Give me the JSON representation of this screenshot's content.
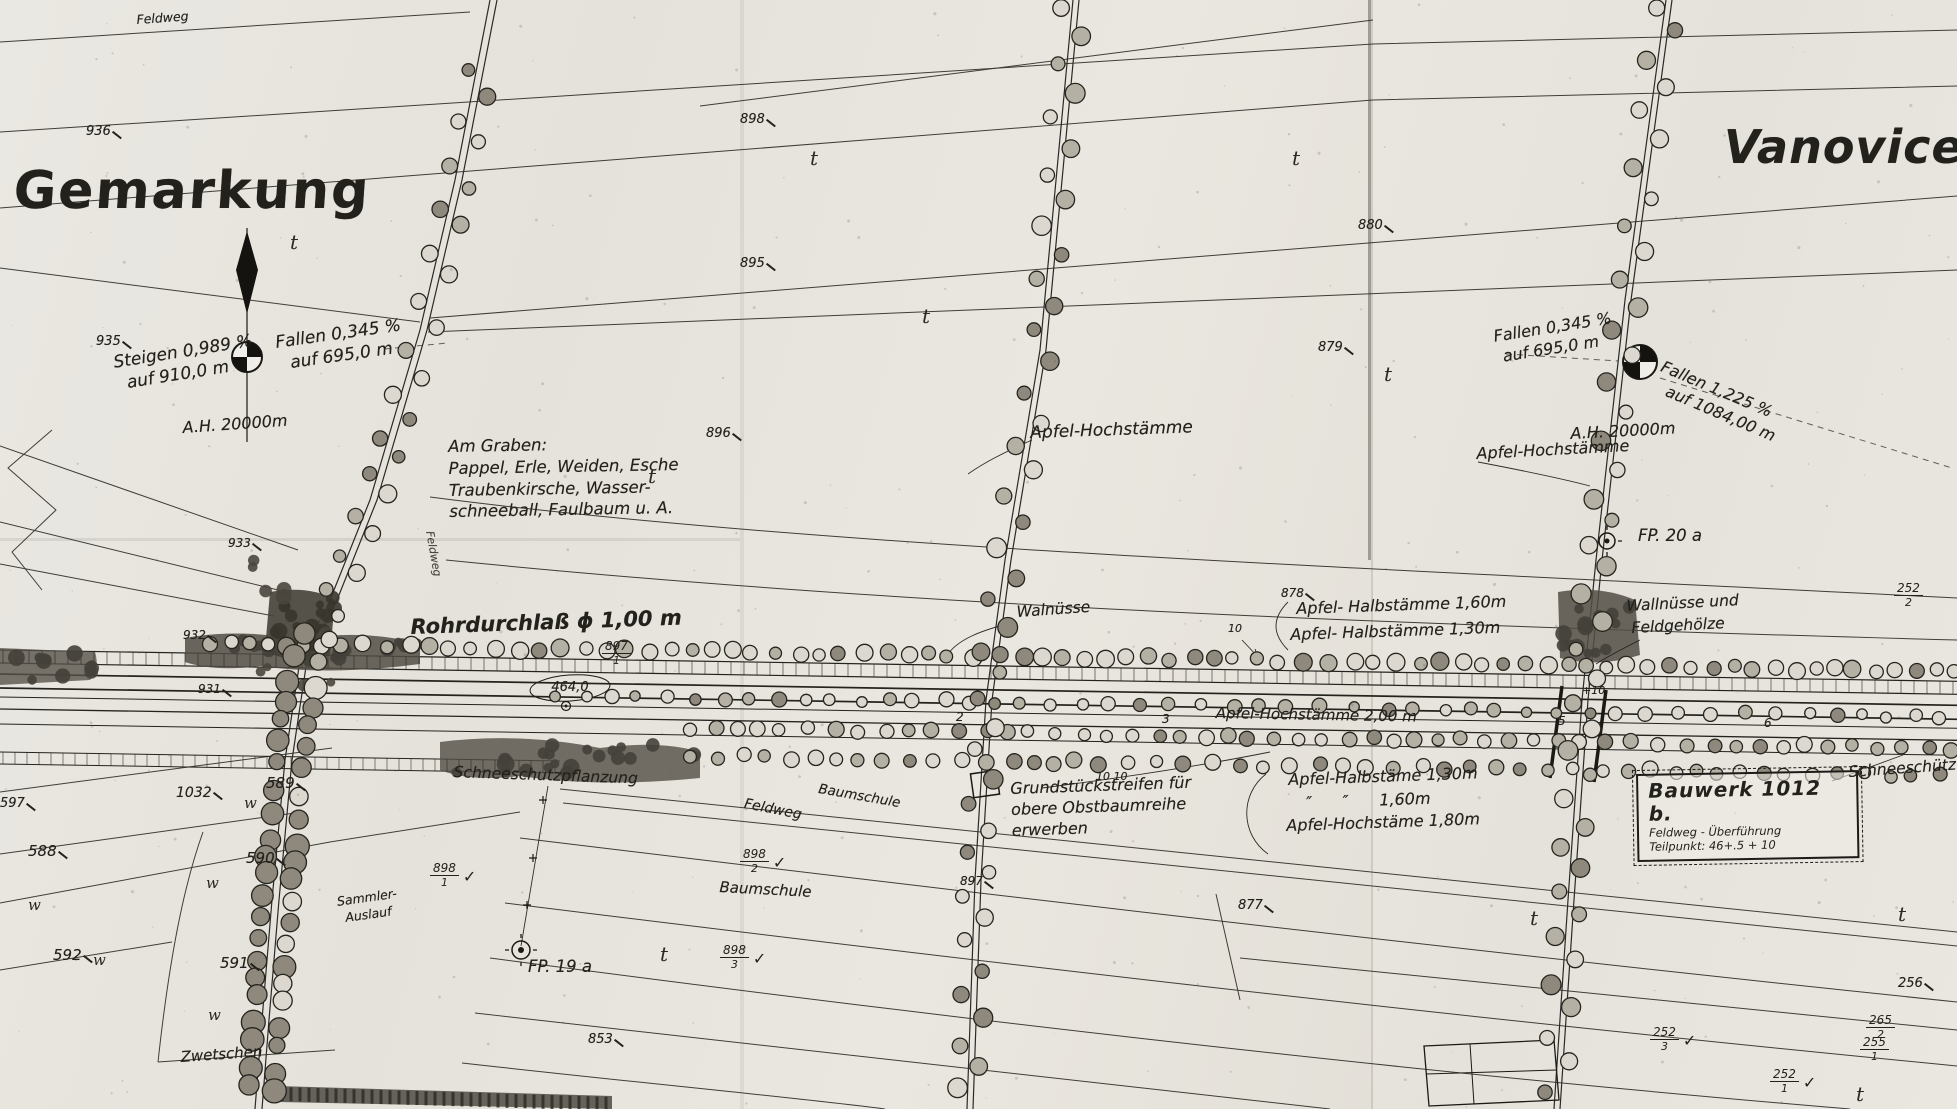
{
  "titles": {
    "gemarkung": "Gemarkung",
    "vanovice": "Vanovice"
  },
  "roads": {
    "feldweg_top": "Feldweg",
    "feldweg_mid": "Feldweg",
    "feldweg_road": "Feldweg"
  },
  "gradients": {
    "steigen": [
      "Steigen 0,989 %",
      "auf 910,0 m"
    ],
    "fallen_left": [
      "Fallen 0,345 %",
      "auf 695,0 m"
    ],
    "ah_left": "A.H. 20000m",
    "fallen_right": [
      "Fallen 0,345 %",
      "auf 695,0 m"
    ],
    "fallen_right2": [
      "Fallen 1,225 %",
      "auf 1084,00 m"
    ],
    "ah_right": "A.H. 20000m"
  },
  "notes": {
    "am_graben": [
      "Am Graben:",
      "Pappel, Erle, Weiden, Esche",
      "Traubenkirsche, Wasser-",
      "schneeball, Faulbaum u. A."
    ],
    "grundstueck": [
      "Grundstückstreifen für",
      "obere Obstbaumreihe",
      "erwerben"
    ]
  },
  "plantings": {
    "apfel_hoch_center": "Apfel-Hochstämme",
    "apfel_hoch_right": "Apfel-Hochstämme",
    "walnuesse": "Walnüsse",
    "halb_160": "Apfel- Halbstämme 1,60m",
    "halb_130": "Apfel- Halbstämme 1,30m",
    "wallnuesse_und": "Wallnüsse und",
    "feldgehoelze": "Feldgehölze",
    "hoch_200": "Apfel-Hochstämme 2,00 m",
    "halb_130b": "Apfel-Halbstäme 1,30m",
    "ditto_160": "″      ″      1,60m",
    "hoch_180": "Apfel-Hochstäme 1,80m",
    "schneeschutz_left": "Schneeschutzpflanzung",
    "schneeschutz_right": "Schneeschütz",
    "baumschule_1": "Baumschule",
    "baumschule_2": "Baumschule",
    "zwetschen": "Zwetschen"
  },
  "structures": {
    "rohrdurchlass": "Rohrdurchlaß ϕ 1,00 m",
    "bauwerk_title": "Bauwerk 1012 b.",
    "bauwerk_line1": "Feldweg - Überführung",
    "bauwerk_line2": "Teilpunkt: 46+.5 + 10",
    "sammler": [
      "Sammler-",
      "Auslauf"
    ],
    "fp19": "FP. 19 a",
    "fp20": "FP. 20 a",
    "station_464": "464,0"
  },
  "stations": {
    "s2": "2",
    "s3": "3",
    "s5": "5",
    "s6": "6",
    "plus10": "+10",
    "ten": "10",
    "tenten": "10 10"
  },
  "parcels": {
    "p936": "936",
    "p935": "935",
    "p933": "933",
    "p932": "932",
    "p931": "931",
    "p1032": "1032",
    "p589": "589",
    "p590": "590",
    "p588": "588",
    "p592": "592",
    "p591": "591",
    "p597": "597",
    "p898": "898",
    "p895": "895",
    "p896": "896",
    "p880": "880",
    "p879": "879",
    "p878": "878",
    "p877": "877",
    "p897": "897",
    "p853": "853",
    "p256": "256"
  },
  "fracs": {
    "f897_1": {
      "n": "897",
      "d": "1"
    },
    "f898_1": {
      "n": "898",
      "d": "1"
    },
    "f898_2": {
      "n": "898",
      "d": "2"
    },
    "f898_3": {
      "n": "898",
      "d": "3"
    },
    "f252_3": {
      "n": "252",
      "d": "3"
    },
    "f265_2": {
      "n": "265",
      "d": "2"
    },
    "f255_1": {
      "n": "255",
      "d": "1"
    },
    "f252_1": {
      "n": "252",
      "d": "1"
    },
    "f252_2": {
      "n": "252",
      "d": "2"
    }
  },
  "symbols": {
    "t": "t",
    "w": "w",
    "check": "✓"
  }
}
